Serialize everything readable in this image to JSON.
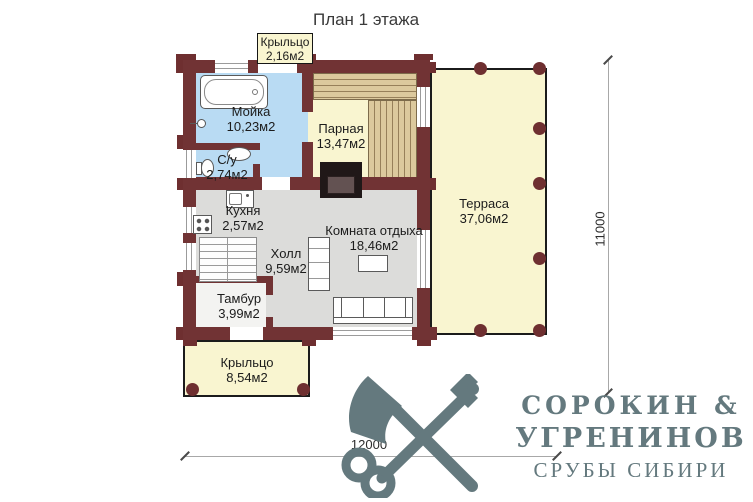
{
  "title": "План 1 этажа",
  "rooms": {
    "kryltso_top": {
      "name": "Крыльцо",
      "area": "2,16м2"
    },
    "moyka": {
      "name": "Мойка",
      "area": "10,23м2"
    },
    "parnaya": {
      "name": "Парная",
      "area": "13,47м2"
    },
    "su": {
      "name": "С/у",
      "area": "2,74м2"
    },
    "terrasa": {
      "name": "Терраса",
      "area": "37,06м2"
    },
    "kuhnya": {
      "name": "Кухня",
      "area": "2,57м2"
    },
    "holl": {
      "name": "Холл",
      "area": "9,59м2"
    },
    "komnata_otdyha": {
      "name": "Комната отдыха",
      "area": "18,46м2"
    },
    "tambur": {
      "name": "Тамбур",
      "area": "3,99м2"
    },
    "kryltso_bottom": {
      "name": "Крыльцо",
      "area": "8,54м2"
    }
  },
  "dimensions": {
    "bottom": "12000",
    "right": "11000"
  },
  "logo": {
    "name_line1": "СОРОКИН &",
    "name_line2": "УГРЕНИНОВ",
    "tagline": "СРУБЫ СИБИРИ"
  },
  "colors": {
    "wall": "#713334",
    "wet_floor": "#b9dbf3",
    "wood_floor": "#f9f5d0",
    "living_floor": "#dcdcda",
    "terrace_border": "#1b1b1b",
    "logo": "#64797e"
  }
}
